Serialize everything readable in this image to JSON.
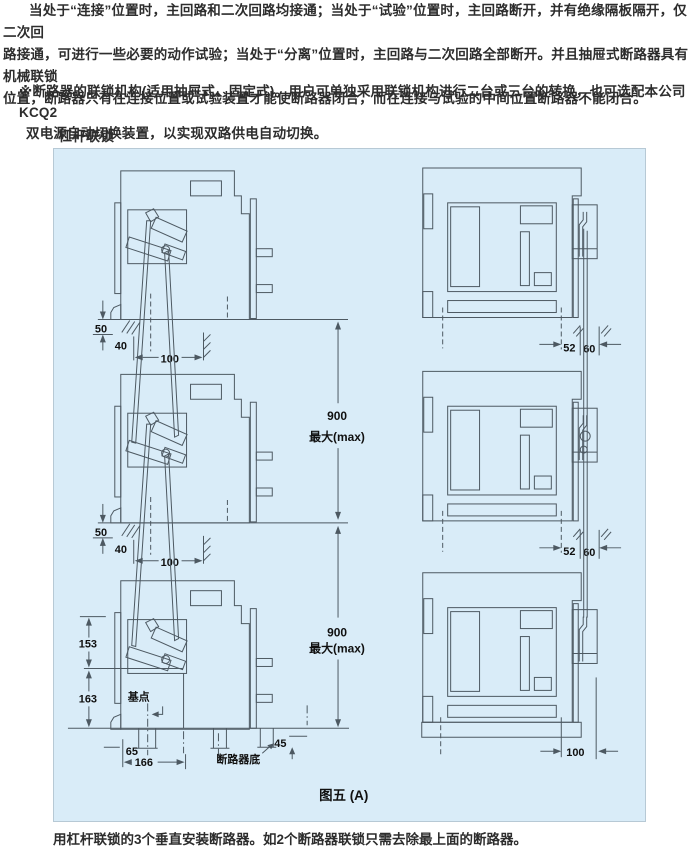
{
  "page": {
    "p1_lines": [
      "当处于“连接”位置时，主回路和二次回路均接通；当处于“试验”位置时，主回路断开，并有绝缘隔板隔开，仅二次回",
      "路接通，可进行一些必要的动作试验；当处于“分离”位置时，主回路与二次回路全部断开。并且抽屉式断路器具有机械联锁",
      "位置，断路器只有在连接位置或试验装置才能使断路器闭合，而在连接与试验的中间位置断路器不能闭合。"
    ],
    "p2_lines": [
      "※断路器的联锁机构(适用抽屉式、固定式)。用户可单独采用联锁机构进行二台或三台的转换，也可选配本公司KCQ2",
      "双电源自动切换装置，以实现双路供电自动切换。"
    ],
    "section_label": "杠杆联锁",
    "footer_note": "用杠杆联锁的3个垂直安装断路器。如2个断路器联锁只需去除最上面的断路器。"
  },
  "figure": {
    "caption": "图五 (A)",
    "colors": {
      "panel_bg": "#d9ecf8",
      "line": "#4d5962",
      "text": "#101010"
    },
    "dims": {
      "d50": "50",
      "d40": "40",
      "d100": "100",
      "d52": "52",
      "d60": "60",
      "d900": "900",
      "dmax": "最大(max)",
      "d153": "153",
      "d163": "163",
      "base_point": "基点",
      "d65": "65",
      "d166": "166",
      "d45": "45",
      "breaker_bottom": "断路器底",
      "d100_bottom": "100"
    }
  }
}
